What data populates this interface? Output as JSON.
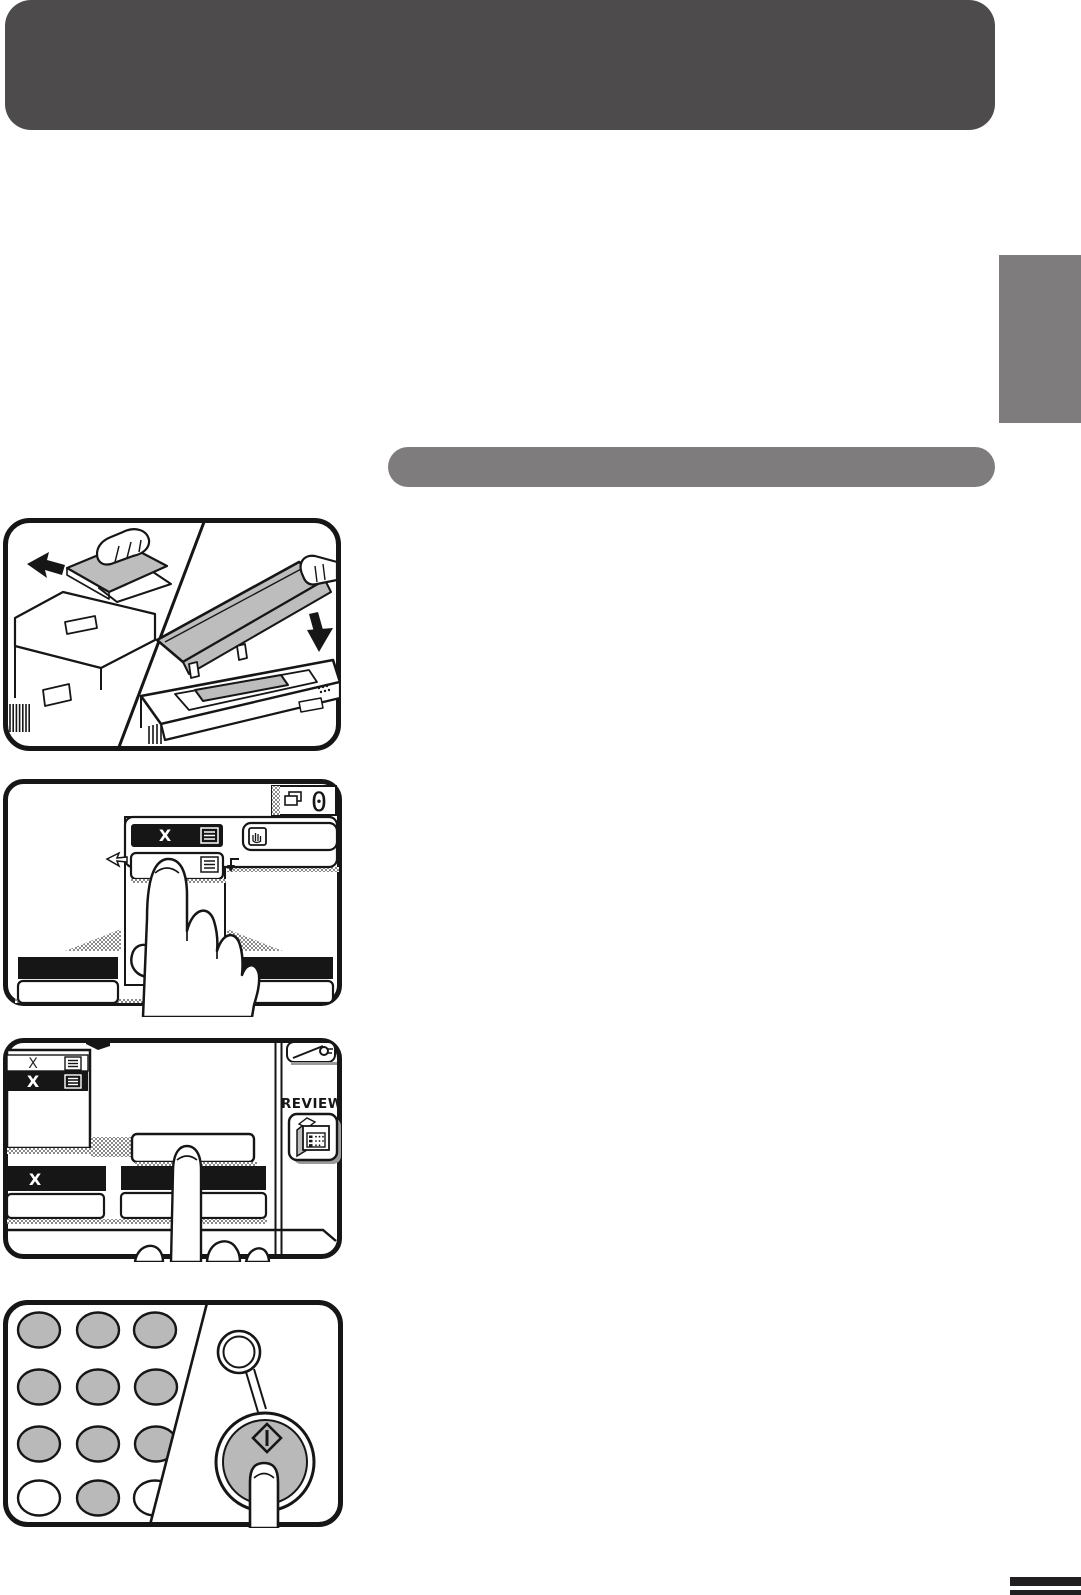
{
  "page": {
    "background": "#ffffff",
    "header_bar": {
      "color": "#4d4b4b"
    },
    "section_title_bar": {
      "color": "#7e7c7c"
    },
    "side_tab": {
      "color": "#7e7c7c"
    },
    "footer_rules": {
      "color": "#221f20"
    }
  },
  "step_load_originals": {
    "illustration": "copier-load-originals-and-platen",
    "icons": [
      "feed-direction-arrow",
      "close-cover-arrow"
    ]
  },
  "step_touch_size": {
    "copy_count_display": {
      "value": "0",
      "icon": "copy-count-icon"
    },
    "popup": {
      "current_size_key": {
        "label": "X",
        "icon": "list-icon"
      },
      "size_option_key": {
        "label": "X",
        "icon": "list-icon"
      },
      "interrupt_key": {
        "icon": "interrupt-hand-icon"
      }
    }
  },
  "step_review": {
    "size_list": {
      "option1": "X",
      "option2": "X"
    },
    "key_counter_key": {
      "icon": "key-icon"
    },
    "review_key": {
      "label": "REVIEW",
      "icon": "review-machine-icon"
    },
    "paper_size_bar": {
      "label": "X"
    }
  },
  "step_start": {
    "clear_key": {
      "icon": "clear-circle-icon"
    },
    "start_key": {
      "icon": "start-diamond-icon"
    }
  },
  "art_colors": {
    "line": "#161616",
    "gray_fill": "#bdbdbd",
    "hatch_gray": "#8a8a8a",
    "key_gray": "#b9b9b9"
  }
}
